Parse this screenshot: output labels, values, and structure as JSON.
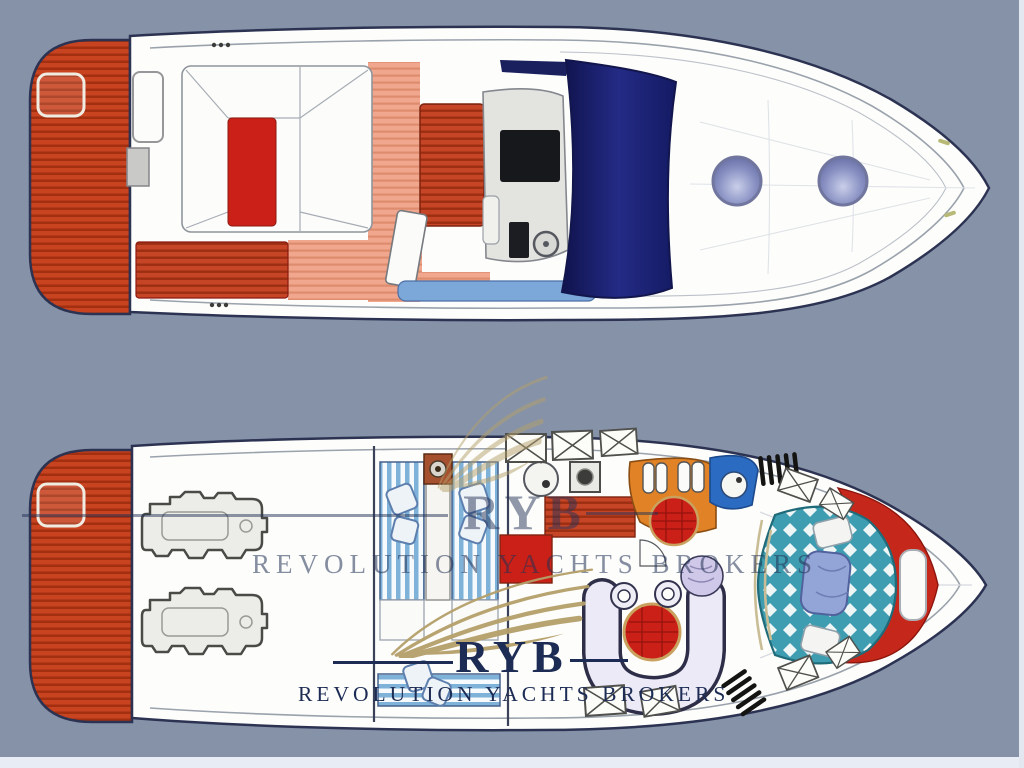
{
  "watermark": {
    "acronym": "RYB",
    "name": "REVOLUTION YACHTS BROKERS"
  },
  "palette": {
    "background": "#8692a8",
    "hull-white": "#fdfdfb",
    "outline-navy": "#2c3352",
    "platform-orange": "#c8431f",
    "platform-stripe": "#a22f10",
    "furniture-red": "#cb2017",
    "teak-salmon": "#f0a78d",
    "windshield-navy": "#1a1f72",
    "walkway-blue": "#7ca7d9",
    "porthole-periwinkle": "#8a92c4",
    "galley-orange": "#e08225",
    "head-blue": "#2b6cc2",
    "bed-teal": "#3e9db0",
    "bed-stripe-blue": "#7fb2d9",
    "sofa-lavender": "#eceaf6",
    "logo-gold": "#b5a06a",
    "logo-navy": "#1d2c55"
  },
  "views": [
    {
      "id": "main-deck-plan",
      "parts": [
        "swim-platform",
        "cockpit-sunpad",
        "aft-bench",
        "wet-bar",
        "helm-console",
        "windshield",
        "side-walkway",
        "foredeck",
        "porthole-port",
        "porthole-starboard"
      ]
    },
    {
      "id": "lower-deck-plan",
      "parts": [
        "swim-platform",
        "engine-room",
        "port-engine",
        "starboard-engine",
        "aft-cabin-twin-beds",
        "galley",
        "head",
        "sideboard",
        "dinette",
        "forward-cabin-double-bed",
        "companionway-steps",
        "locker-hatches"
      ]
    }
  ]
}
